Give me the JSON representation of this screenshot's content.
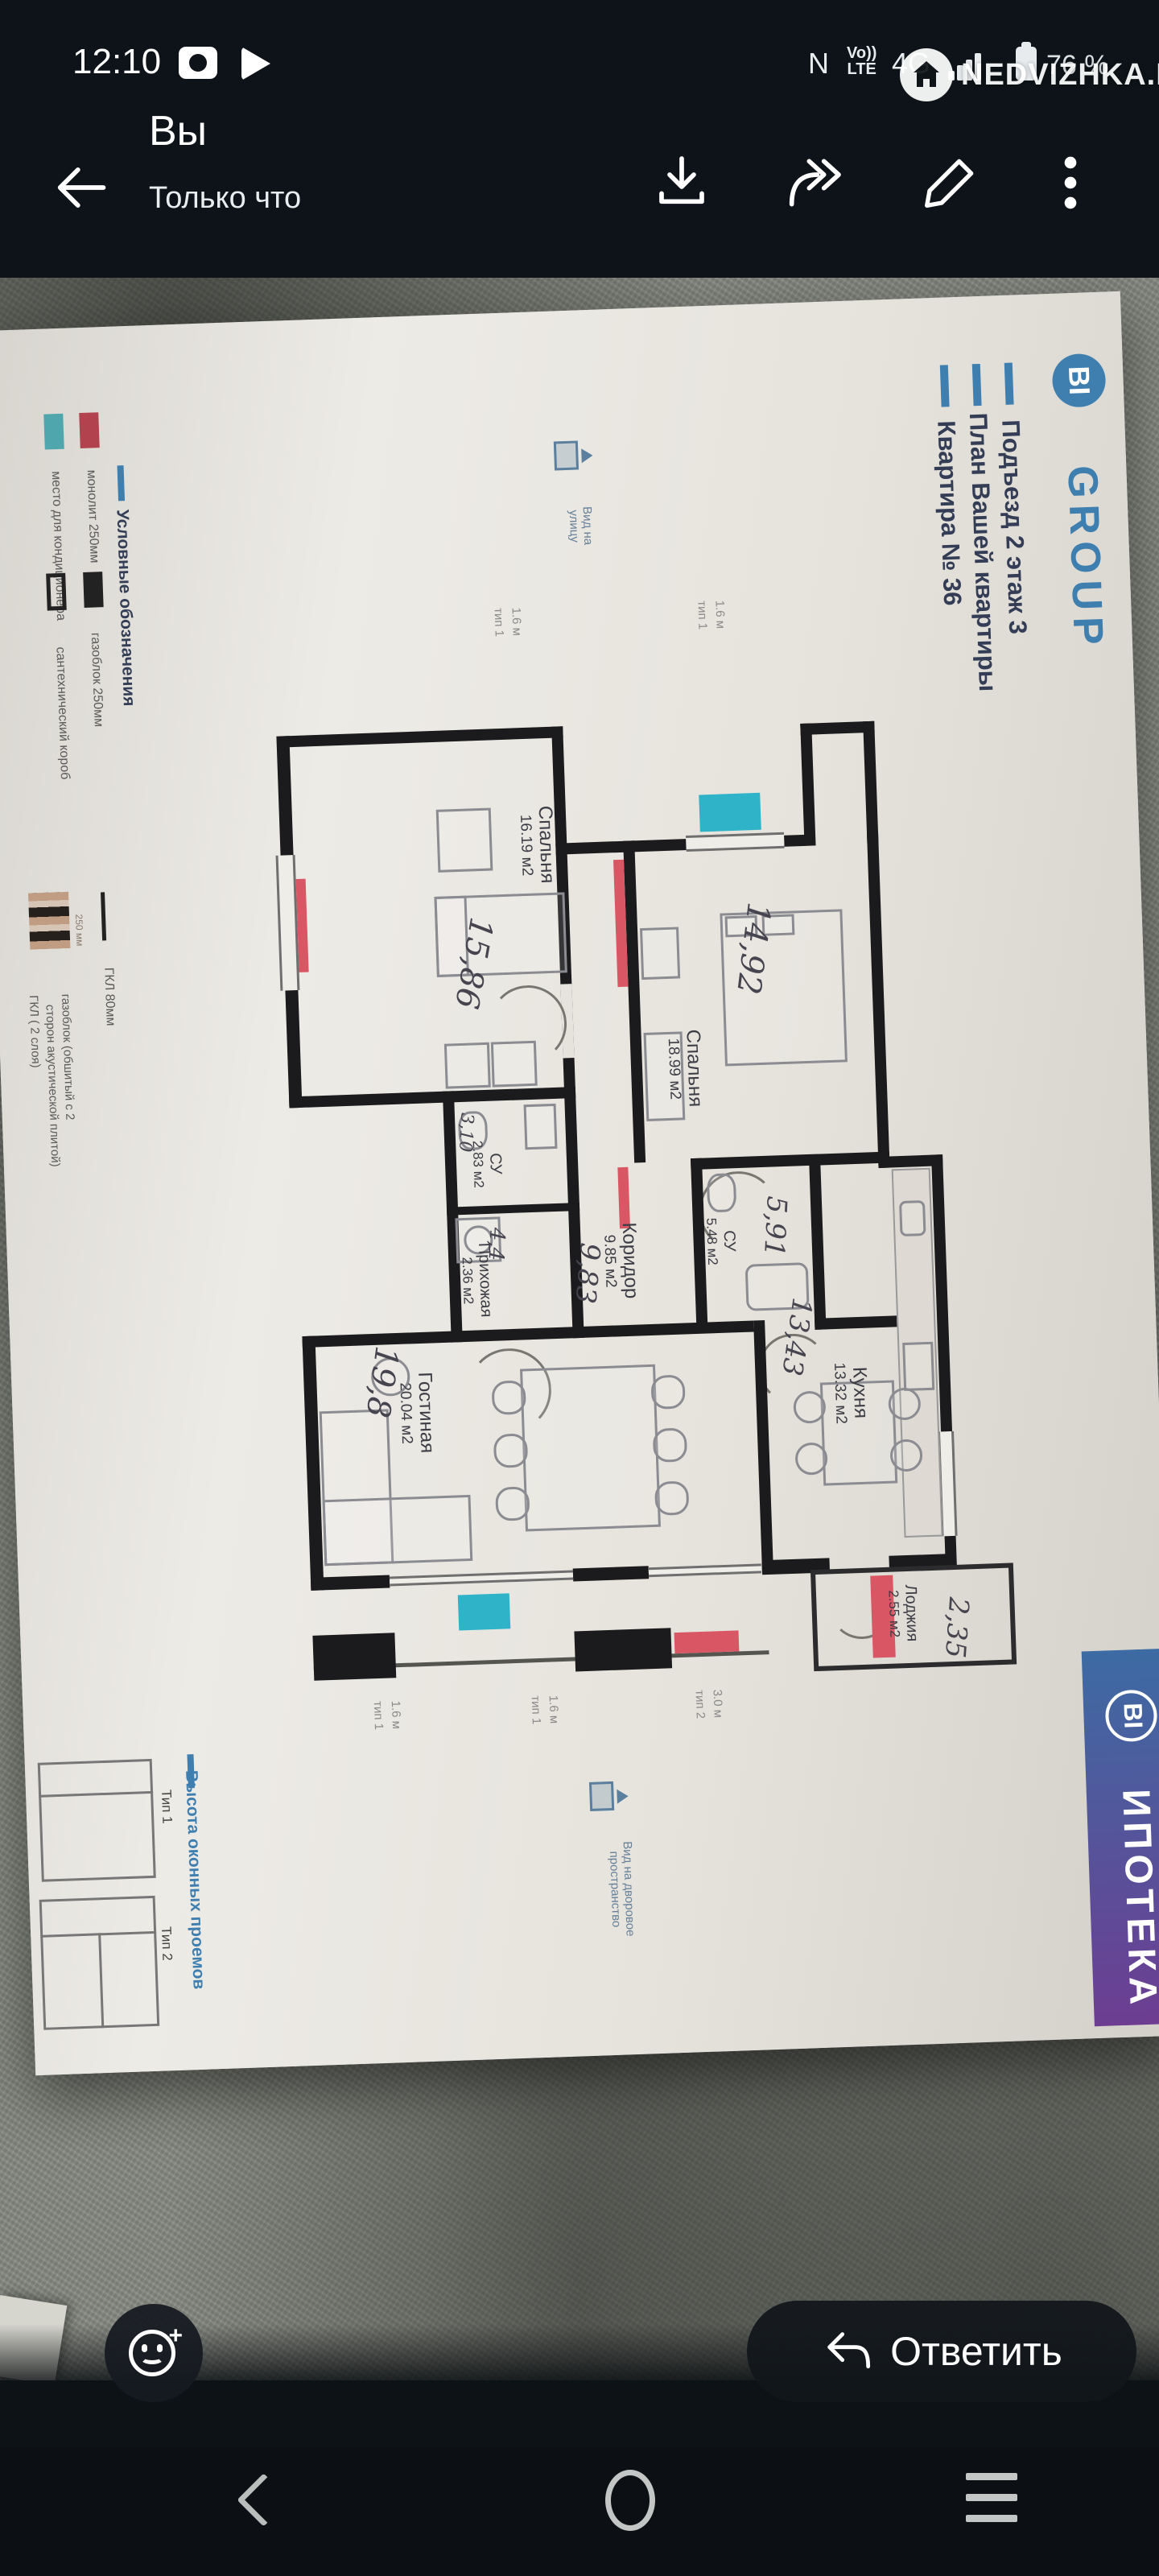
{
  "status": {
    "time": "12:10",
    "nfc": "N",
    "volte_top": "Vo))",
    "volte_bottom": "LTE",
    "network": "4G",
    "battery_percent": "76 %"
  },
  "watermark": {
    "text": "NEDVIZHKA.KZ"
  },
  "header": {
    "title": "Вы",
    "subtitle": "Только что"
  },
  "doc": {
    "brand": {
      "bi": "BI",
      "group": "GROUP"
    },
    "title_lines": [
      "Подъезд 2 этаж 3",
      "План Вашей квартиры",
      "Квартира № 36"
    ],
    "legend": {
      "title": "Условные обозначения",
      "monolith": "монолит 250мм",
      "ac": "место для кондиционера",
      "gasblock": "газоблок 250мм",
      "plumb": "сантехнический короб",
      "gkl": "ГКЛ 80мм",
      "dim": "250 мм",
      "gkl2_l1": "газоблок (обшитый с 2",
      "gkl2_l2": "сторон акустической плитой)",
      "gkl2_l3": "ГКЛ ( 2 слоя)"
    },
    "rooms": {
      "bedroom1": {
        "name": "Спальня",
        "area": "16.19 м2",
        "hand": "15,86"
      },
      "bedroom2": {
        "name": "Спальня",
        "area": "18.99 м2",
        "hand": "14,92"
      },
      "su1": {
        "name": "СУ",
        "area": "2.83 м2",
        "hand": "3,10"
      },
      "hall": {
        "name": "Прихожая",
        "area": "2.36 м2",
        "hand": "4,4"
      },
      "corridor": {
        "name": "Коридор",
        "area": "9.85 м2",
        "hand": "9,83"
      },
      "su2": {
        "name": "СУ",
        "area": "5.48 м2",
        "hand": "5,91"
      },
      "kitchen": {
        "name": "Кухня",
        "area": "13.32 м2",
        "hand": "13,43"
      },
      "living": {
        "name": "Гостиная",
        "area": "20.04 м2",
        "hand": "19,8"
      },
      "loggia": {
        "name": "Лоджия",
        "area": "2.55 м2",
        "hand": "2,35"
      }
    },
    "window_types": {
      "t1": "тип 1",
      "t1h": "1.6 м",
      "t2": "тип 2",
      "t2h": "3.0 м"
    },
    "views": {
      "street_l1": "Вид на",
      "street_l2": "улицу",
      "yard_l1": "Вид на дворовое",
      "yard_l2": "пространство"
    },
    "window_legend": {
      "title": "Высота оконных проемов",
      "type1": "Тип 1",
      "type2": "Тип 2"
    },
    "mortgage": {
      "bi": "BI",
      "label": "ИПОТЕКА"
    },
    "colors": {
      "brand_blue": "#3e7fb0",
      "radiator_red": "#d95765",
      "ac_teal": "#2fb3c9",
      "mortgage_top": "#3d6ba3",
      "mortgage_bottom": "#6d3d92"
    }
  },
  "actions": {
    "reply": "Ответить"
  }
}
